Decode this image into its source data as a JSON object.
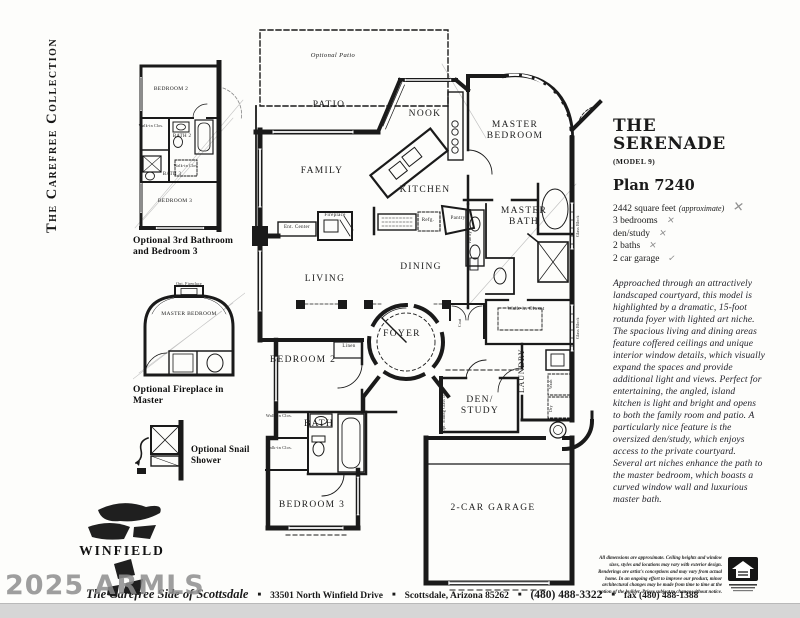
{
  "page": {
    "banner": "The Carefree Collection",
    "watermark": "2025 ARMLS"
  },
  "logo": {
    "name": "WINFIELD"
  },
  "info": {
    "title_line1": "THE",
    "title_line2": "SERENADE",
    "model": "(MODEL 9)",
    "plan": "Plan 7240",
    "features": [
      {
        "text": "2442 square feet",
        "note": "(approximate)",
        "mark": "✕"
      },
      {
        "text": "3 bedrooms",
        "note": "",
        "mark": "✕"
      },
      {
        "text": "den/study",
        "note": "",
        "mark": "✕"
      },
      {
        "text": "2 baths",
        "note": "",
        "mark": "✕"
      },
      {
        "text": "2 car garage",
        "note": "",
        "mark": "✓"
      }
    ],
    "description": "Approached through an attractively landscaped courtyard, this model is highlighted by a dramatic, 15-foot rotunda foyer with lighted art niche. The spacious living and dining areas feature coffered ceilings and unique interior window details, which visually expand the spaces and provide additional light and views. Perfect for entertaining, the angled, island kitchen is light and bright and opens to both the family room and patio. A particularly nice feature is the oversized den/study, which enjoys access to the private courtyard. Several art niches enhance the path to the master bedroom, which boasts a curved window wall and luxurious master bath.",
    "disclaimer": "All dimensions are approximate. Ceiling heights and window sizes, styles and locations may vary with exterior design. Renderings are artist's conceptions and may vary from actual home. In an ongoing effort to improve our product, minor architectural changes may be made from time to time at the option of the builder. Prices subject to change without notice."
  },
  "footer": {
    "tagline": "The Carefree Side of Scottsdale",
    "separator": "■",
    "address": "33501 North Winfield Drive",
    "city": "Scottsdale, Arizona 85262",
    "phone": "(480) 488-3322",
    "fax": "fax (480) 488-1388"
  },
  "floorplan": {
    "labels": {
      "optional_patio": "Optional Patio",
      "patio": "PATIO",
      "nook": "NOOK",
      "family": "FAMILY",
      "kitchen": "KITCHEN",
      "living": "LIVING",
      "dining": "DINING",
      "foyer": "FOYER",
      "master_bedroom": "MASTER BEDROOM",
      "master_bath": "MASTER BATH",
      "bedroom2": "BEDROOM 2",
      "bedroom3": "BEDROOM 3",
      "bath": "BATH",
      "linen": "Linen",
      "laundry": "LAUNDRY",
      "den_study": "DEN/ STUDY",
      "garage": "2-CAR GARAGE",
      "walk_in_closet": "Walk-in Closet",
      "walk_in_clos": "Walk-in Clos.",
      "ent_center": "Ent. Center",
      "fireplace": "Fireplace",
      "pantry": "Pantry",
      "refrig": "Refg.",
      "vanity": "Vanity",
      "glass_block": "Glass Block",
      "opt_sliding_door": "Opt. Sliding Glass Door",
      "wash": "Wash",
      "dry": "Dry",
      "coat": "Coat"
    }
  },
  "optional_plans": {
    "plan_a": {
      "caption": "Optional 3rd Bathroom and Bedroom 3",
      "bedroom2": "BEDROOM 2",
      "bath2": "BATH 2",
      "bath3": "BATH 3",
      "bedroom3": "BEDROOM 3",
      "closet": "Walk-in Clos."
    },
    "plan_b": {
      "caption": "Optional Fireplace in Master",
      "master_bedroom": "MASTER BEDROOM",
      "fireplace": "Opt. Fireplace"
    },
    "plan_c": {
      "caption": "Optional Snail Shower"
    }
  }
}
